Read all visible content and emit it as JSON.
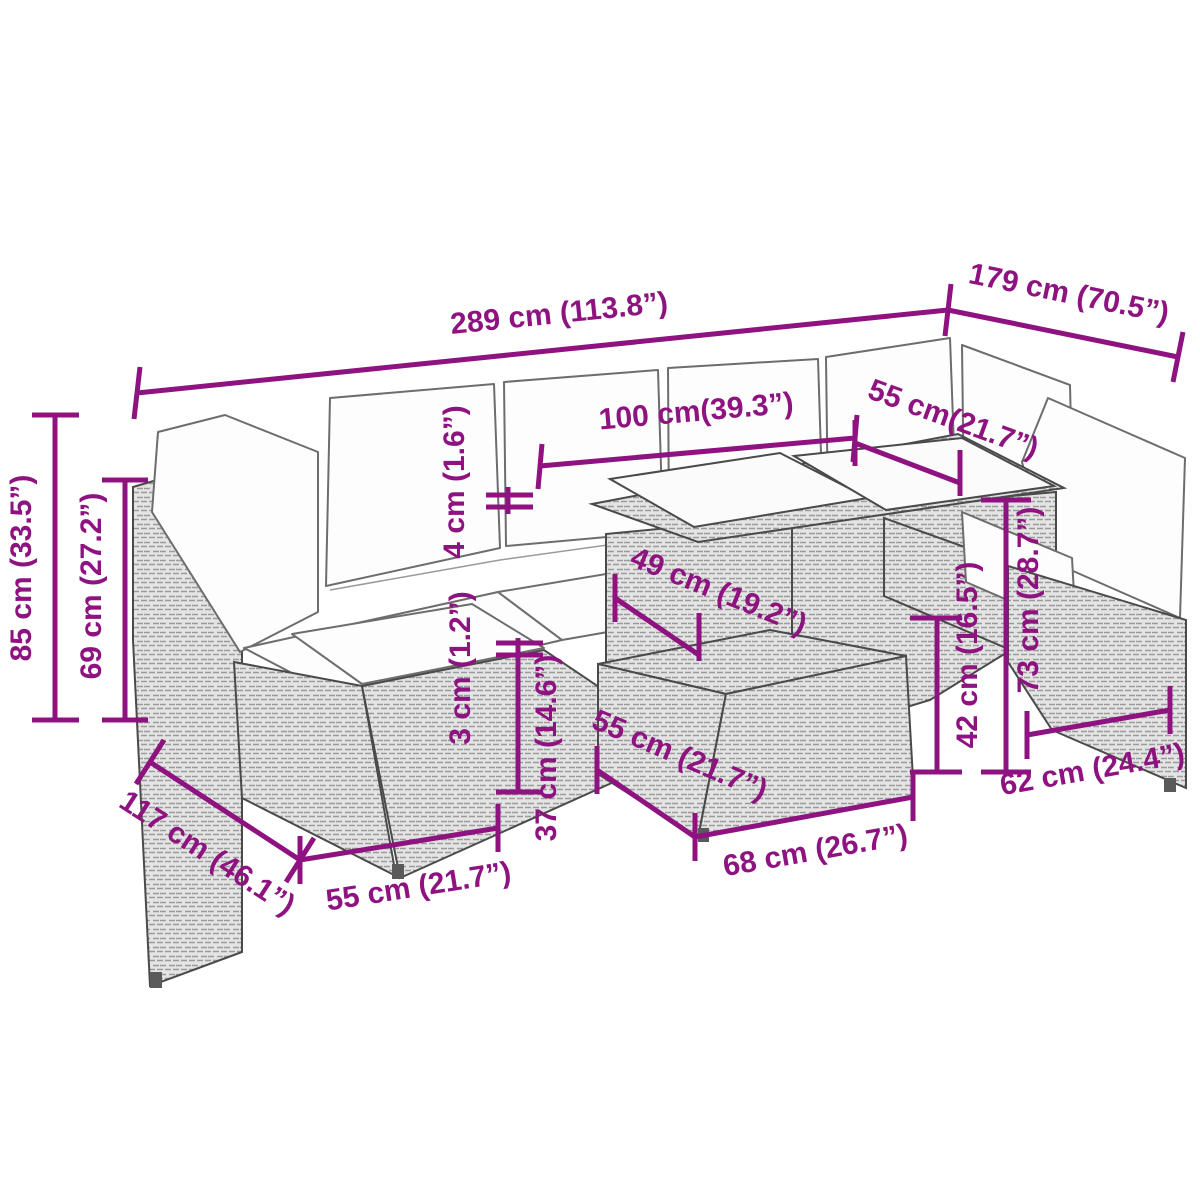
{
  "diagram": {
    "type": "furniture-dimension-diagram",
    "subject": "poly-rattan garden lounge set with cushions, table and footstools",
    "accent_color": "#8E1380",
    "outline_color": "#4a4a4a",
    "labels": {
      "overall_width": "289 cm (113.8”)",
      "overall_depth_right": "179 cm (70.5”)",
      "total_height": "85 cm (33.5”)",
      "armrest_height": "69 cm (27.2”)",
      "table_length": "100 cm(39.3”)",
      "seat_depth_back_right": "55 cm(21.7”)",
      "cushion_thickness": "4 cm (1.6”)",
      "table_inner_width": "49 cm (19.2”)",
      "pad_thickness": "3 cm (1.2”)",
      "stool_height": "37 cm (14.6”)",
      "stool_depth": "55 cm (21.7”)",
      "stool_width": "68 cm (26.7”)",
      "seat_height": "42 cm (16.5”)",
      "backrest_height": "73 cm (28.7”)",
      "chair_depth_right": "62 cm (24.4”)",
      "section_depth_left": "117 cm (46.1”)",
      "ottoman_width_left": "55 cm (21.7”)"
    }
  }
}
